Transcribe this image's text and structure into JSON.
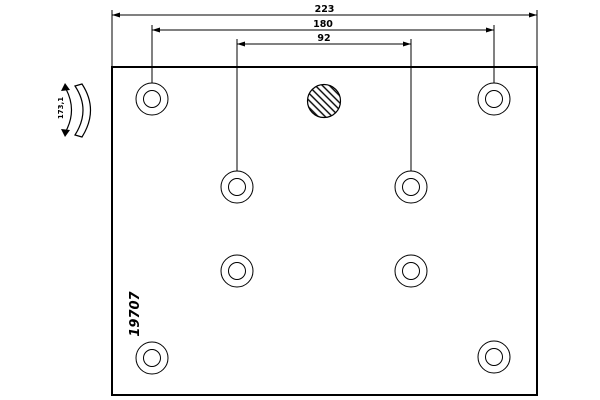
{
  "drawing": {
    "type": "brake-lining-technical-drawing",
    "part_number": "19707",
    "radius_label": "173,1",
    "colors": {
      "line": "#000000",
      "background": "#ffffff"
    },
    "plate": {
      "x": 112,
      "y": 67,
      "width": 425,
      "height": 328
    },
    "dimensions": [
      {
        "label": "223",
        "from_x": 112,
        "to_x": 537,
        "y": 15,
        "ext_bottom": 67
      },
      {
        "label": "180",
        "from_x": 152,
        "to_x": 494,
        "y": 30,
        "ext_bottom": 84
      },
      {
        "label": "92",
        "from_x": 237,
        "to_x": 411,
        "y": 44,
        "ext_bottom": 171
      }
    ],
    "rivet_holes": {
      "outer_radius": 16,
      "inner_radius": 8.5,
      "centers": [
        {
          "cx": 152,
          "cy": 99
        },
        {
          "cx": 494,
          "cy": 99
        },
        {
          "cx": 237,
          "cy": 187
        },
        {
          "cx": 411,
          "cy": 187
        },
        {
          "cx": 237,
          "cy": 271
        },
        {
          "cx": 411,
          "cy": 271
        },
        {
          "cx": 152,
          "cy": 358
        },
        {
          "cx": 494,
          "cy": 357
        }
      ]
    },
    "hatched_hole": {
      "cx": 324,
      "cy": 101,
      "r": 16.5
    },
    "part_number_pos": {
      "x": 139,
      "y": 314,
      "rotate": -90
    },
    "radius_label_pos": {
      "x": 63,
      "y": 108,
      "rotate": -90
    }
  }
}
